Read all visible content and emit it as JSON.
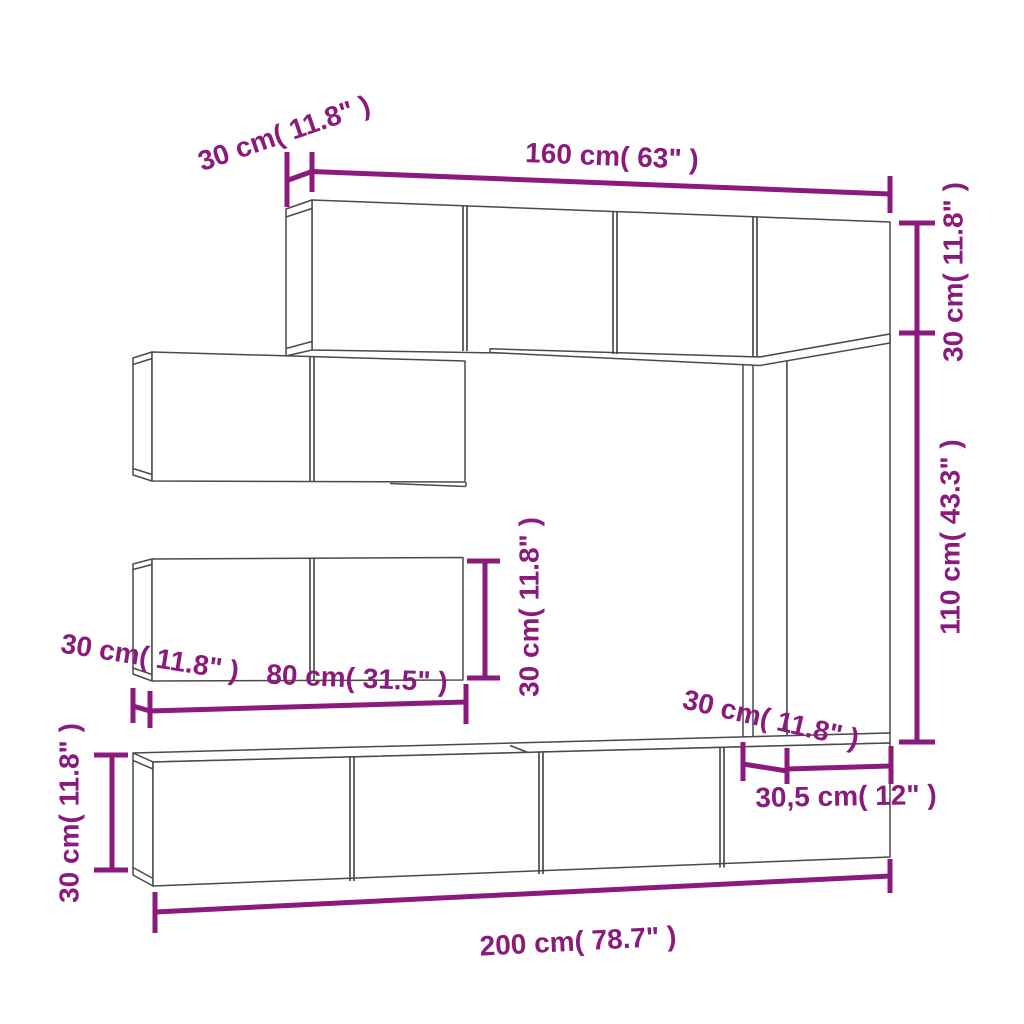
{
  "colors": {
    "dimension": "#8A1A7C",
    "furniture": "#4A4A4A",
    "background": "#FFFFFF"
  },
  "annotations": {
    "top_cabinet_depth": "30 cm( 11.8\" )",
    "top_cabinet_width": "160 cm( 63\" )",
    "upper_right_height": "30 cm( 11.8\" )",
    "column_height": "110 cm( 43.3\" )",
    "shelf_height": "30 cm( 11.8\" )",
    "shelf_depth": "30 cm( 11.8\" )",
    "shelf_width": "80 cm( 31.5\" )",
    "bottom_cabinet_height": "30 cm( 11.8\" )",
    "column_depth": "30 cm( 11.8\" )",
    "column_width": "30,5 cm( 12\" )",
    "bottom_cabinet_width": "200 cm( 78.7\" )"
  }
}
